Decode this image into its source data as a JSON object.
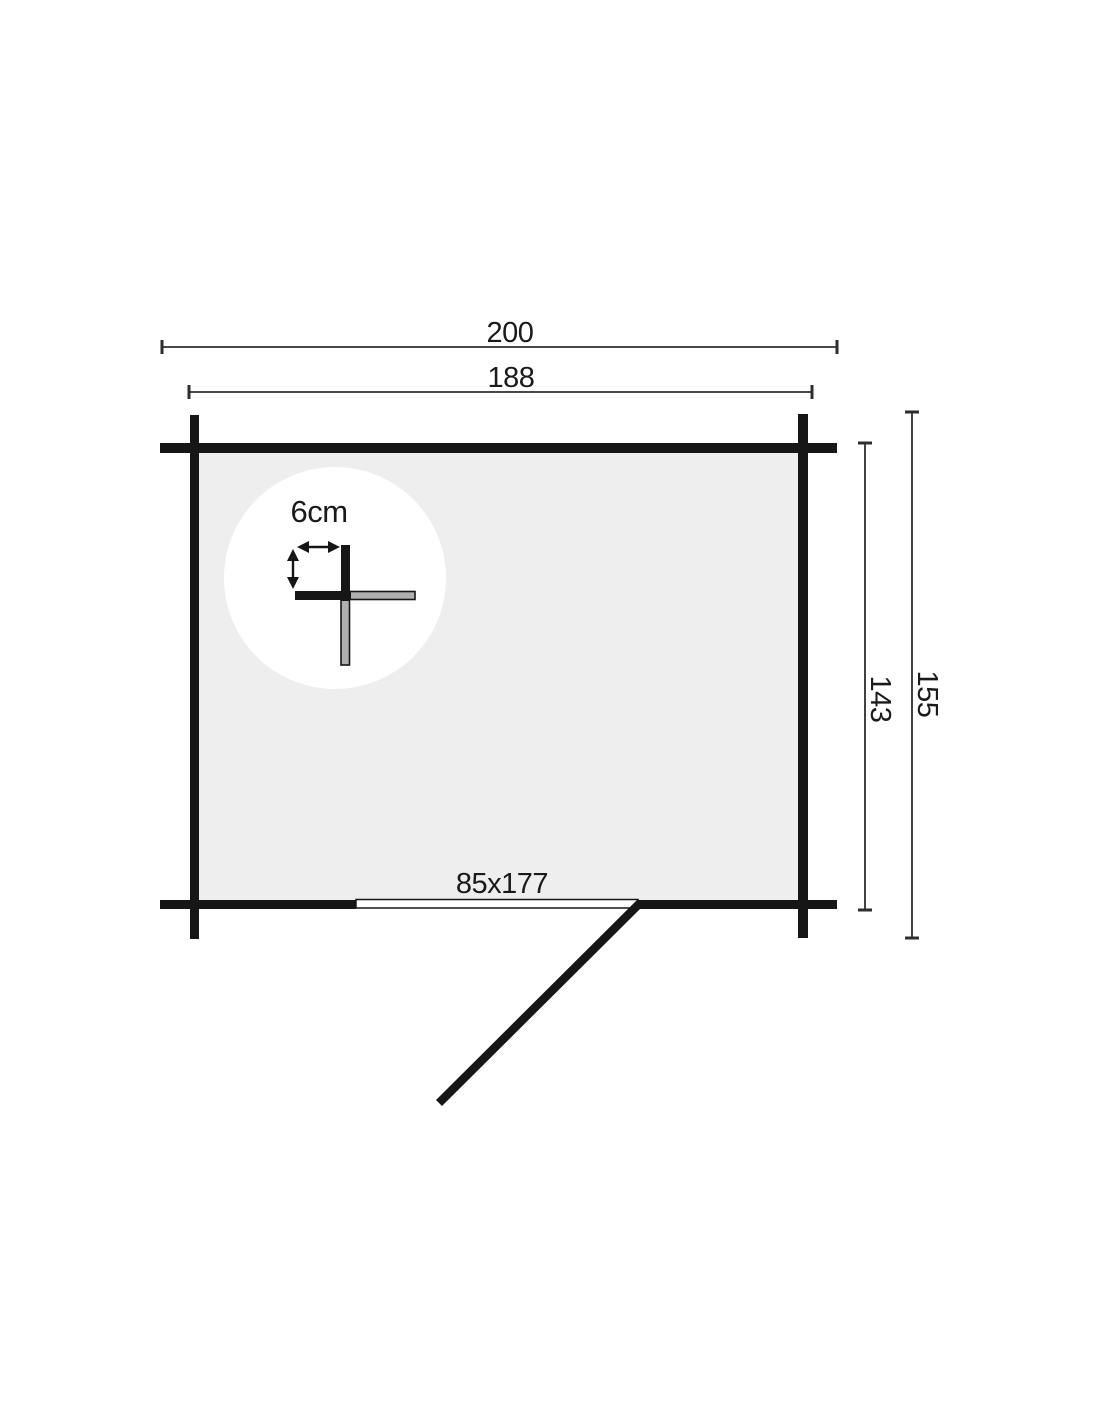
{
  "plan": {
    "kind": "log-cabin floor plan",
    "labels": {
      "outer_width": "200",
      "inner_width": "188",
      "outer_depth": "155",
      "inner_depth": "143",
      "door_size": "85x177",
      "wall_thickness": "6cm"
    },
    "colors": {
      "wall": "#161616",
      "floor": "#eeeeee",
      "detail_plank": "#b0b0b0",
      "dimension_line": "#2e2e2e",
      "background": "#ffffff"
    }
  }
}
